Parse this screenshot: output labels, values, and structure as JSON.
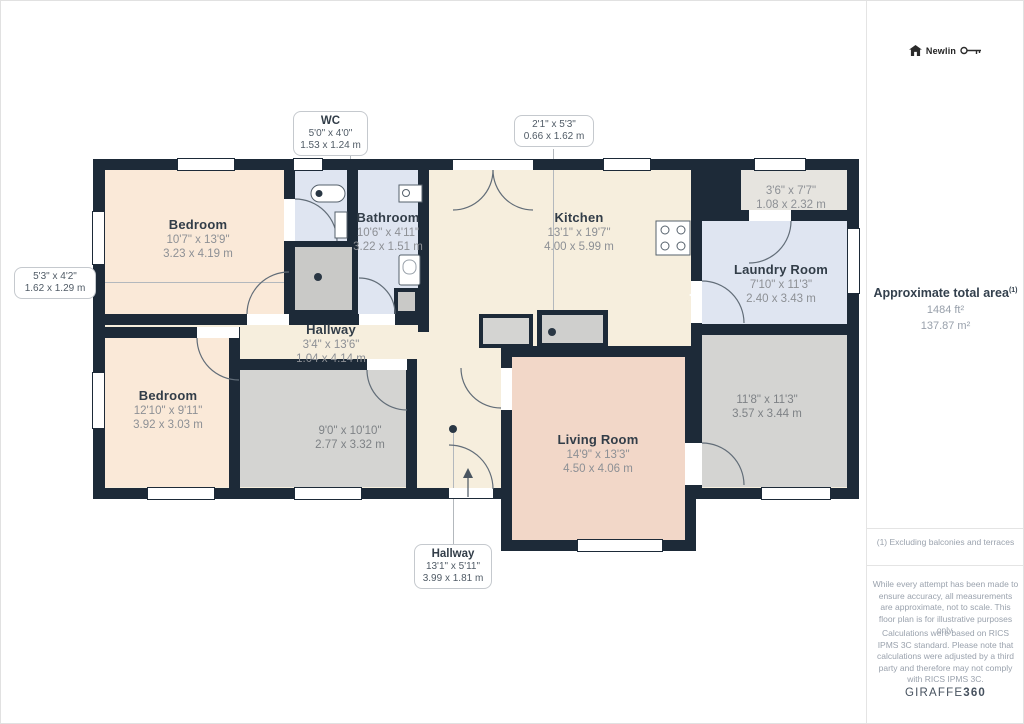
{
  "branding": {
    "logo_text": "Newlin",
    "watermark_regular": "GIRAFFE",
    "watermark_bold": "360"
  },
  "sidebar": {
    "total_area": {
      "label": "Approximate total area",
      "superscript": "(1)",
      "imperial": "1484 ft²",
      "metric": "137.87 m²"
    },
    "footnote": "(1) Excluding balconies and terraces",
    "disclaimers": [
      "While every attempt has been made to ensure accuracy, all measurements are approximate, not to scale. This floor plan is for illustrative purposes only.",
      "Calculations were based on RICS IPMS 3C standard. Please note that calculations were adjusted by a third party and therefore may not comply with RICS IPMS 3C."
    ]
  },
  "rooms": {
    "bedroom_top": {
      "name": "Bedroom",
      "imperial": "10'7\" x 13'9\"",
      "metric": "3.23 x 4.19 m"
    },
    "bedroom_bottom": {
      "name": "Bedroom",
      "imperial": "12'10\" x 9'11\"",
      "metric": "3.92 x 3.03 m"
    },
    "bathroom": {
      "name": "Bathroom",
      "imperial": "10'6\" x 4'11\"",
      "metric": "3.22 x 1.51 m"
    },
    "kitchen": {
      "name": "Kitchen",
      "imperial": "13'1\" x 19'7\"",
      "metric": "4.00 x 5.99 m"
    },
    "laundry": {
      "name": "Laundry Room",
      "imperial": "7'10\" x 11'3\"",
      "metric": "2.40 x 3.43 m"
    },
    "hallway_center": {
      "name": "Hallway",
      "imperial": "3'4\" x 13'6\"",
      "metric": "1.04 x 4.14 m"
    },
    "living": {
      "name": "Living Room",
      "imperial": "14'9\" x 13'3\"",
      "metric": "4.50 x 4.06 m"
    },
    "room_center": {
      "imperial": "9'0\" x 10'10\"",
      "metric": "2.77 x 3.32 m"
    },
    "room_bottom_right": {
      "imperial": "11'8\" x 11'3\"",
      "metric": "3.57 x 3.44 m"
    },
    "room_top_right": {
      "imperial": "3'6\" x 7'7\"",
      "metric": "1.08 x 2.32 m"
    }
  },
  "callouts": {
    "wc": {
      "name": "WC",
      "imperial": "5'0\" x 4'0\"",
      "metric": "1.53 x 1.24 m"
    },
    "kitchen_closet": {
      "imperial": "2'1\" x 5'3\"",
      "metric": "0.66 x 1.62 m"
    },
    "left_closet": {
      "imperial": "5'3\" x 4'2\"",
      "metric": "1.62 x 1.29 m"
    },
    "hallway_entry": {
      "name": "Hallway",
      "imperial": "13'1\" x 5'11\"",
      "metric": "3.99 x 1.81 m"
    }
  },
  "colors": {
    "wall": "#1d2a38",
    "cream": "#f6eedd",
    "peach": "#fae9d8",
    "periwinkle": "#dfe5f1",
    "pink": "#f2d7c8",
    "gray_room": "#d4d4d2",
    "gray_closet": "#c9c9c7",
    "room_top_right_fill": "#e6e4df"
  }
}
